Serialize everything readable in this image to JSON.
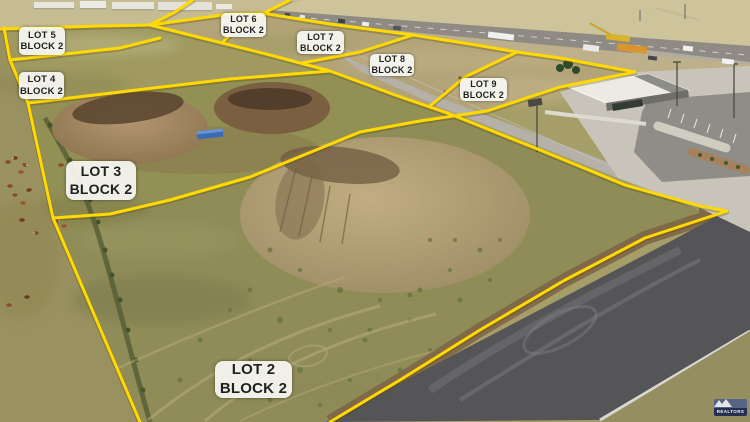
{
  "overlay": {
    "labels": [
      {
        "id": "lot5",
        "line1": "LOT 5",
        "line2": "BLOCK 2"
      },
      {
        "id": "lot4",
        "line1": "LOT 4",
        "line2": "BLOCK 2"
      },
      {
        "id": "lot6",
        "line1": "LOT 6",
        "line2": "BLOCK 2"
      },
      {
        "id": "lot7",
        "line1": "LOT 7",
        "line2": "BLOCK 2"
      },
      {
        "id": "lot8",
        "line1": "LOT 8",
        "line2": "BLOCK 2"
      },
      {
        "id": "lot9",
        "line1": "LOT 9",
        "line2": "BLOCK 2"
      },
      {
        "id": "lot3",
        "line1": "LOT 3",
        "line2": "BLOCK 2"
      },
      {
        "id": "lot2",
        "line1": "LOT 2",
        "line2": "BLOCK 2"
      }
    ]
  },
  "watermark": {
    "brand": "REALTORS"
  },
  "scene": {
    "colors": {
      "overlay_yellow": "#FFD900",
      "label_bg": "#F7F6F2",
      "label_text": "#1F1F1F",
      "asphalt": "#555457",
      "grass_olive": "#949055",
      "dirt_tan": "#B5A37B",
      "logo_navy": "#1C2750"
    }
  }
}
